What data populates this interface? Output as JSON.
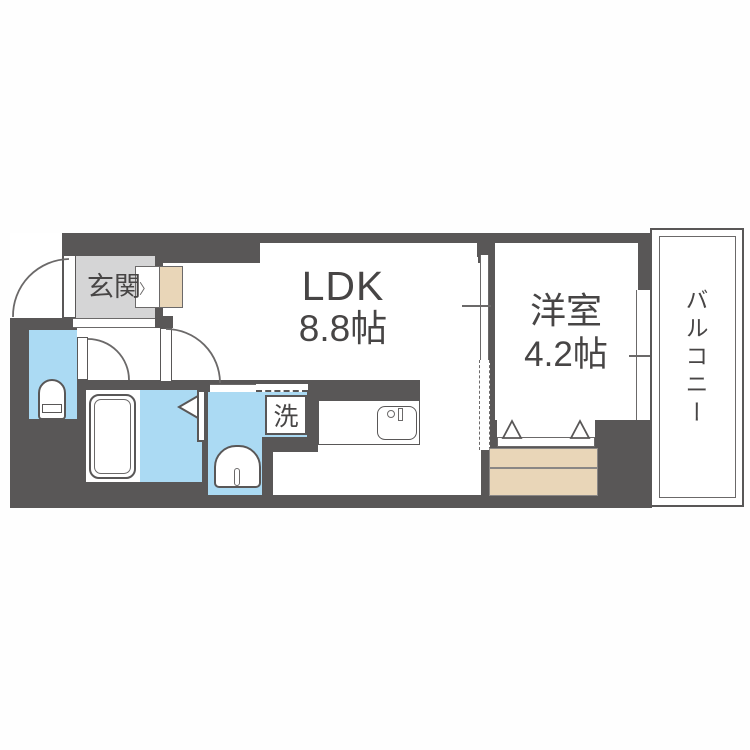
{
  "title": "floor-plan",
  "rooms": {
    "genkan": {
      "label": "玄関"
    },
    "ldk": {
      "label": "LDK",
      "size": "8.8帖"
    },
    "bedroom": {
      "label": "洋室",
      "size": "4.2帖"
    },
    "balcony": {
      "label": "バルコニー"
    },
    "laundry": {
      "label": "洗"
    }
  },
  "markers": {
    "step_arrow": "〉"
  },
  "colors": {
    "wall": "#595757",
    "line": "#6b6969",
    "genkan": "#d5d5d6",
    "wet": "#abdaf3",
    "wood": "#e9d6b8",
    "text": "#474545",
    "white": "#ffffff"
  }
}
